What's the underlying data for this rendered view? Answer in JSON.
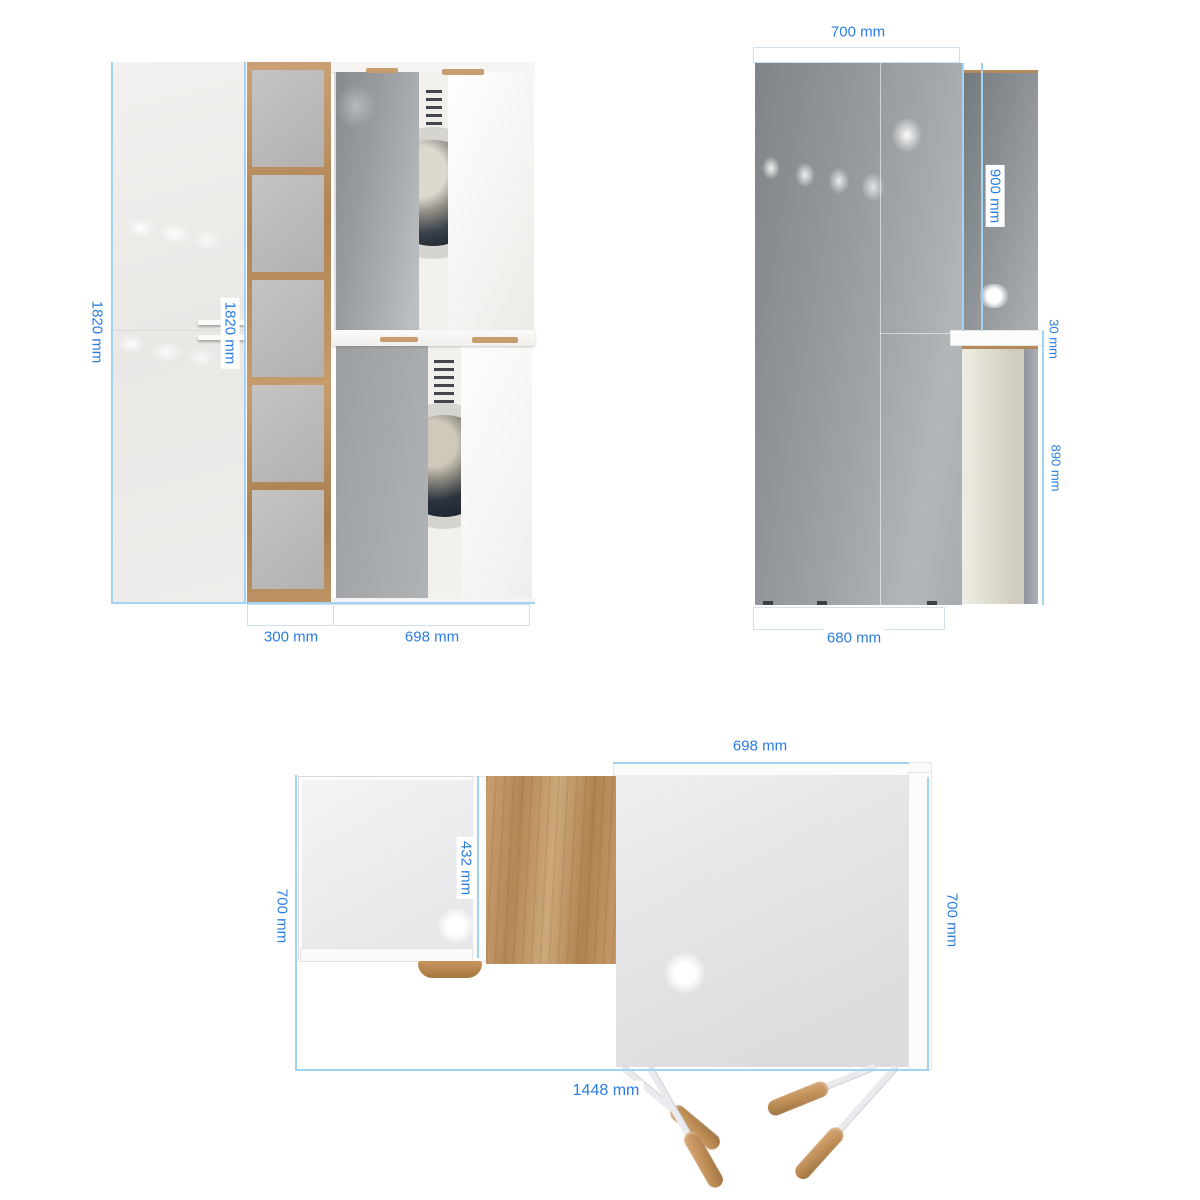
{
  "meta": {
    "units": "mm",
    "colors": {
      "dimension_text": "#2b7ce0",
      "dimension_line": "#a3d3f2",
      "bracket_border": "#cfe0ee",
      "wood_frame": "#c1955f",
      "glossy_gray_panel": "#9aa0a5",
      "white_panel": "#f1efec",
      "beige_panel": "#d6d2c6",
      "leg_wood": "#bc8c55",
      "background": "#ffffff"
    }
  },
  "front_view": {
    "labels": {
      "total_height": "1820 mm",
      "door_height": "1820 mm",
      "shelf_width": "300 mm",
      "cabinet_width": "698 mm"
    }
  },
  "side_view": {
    "labels": {
      "top_depth": "700 mm",
      "upper_panel_height": "900 mm",
      "worktop_thickness": "30 mm",
      "lower_panel_height": "890 mm",
      "bottom_depth": "680 mm"
    }
  },
  "plan_view": {
    "labels": {
      "cabinet_depth": "698 mm",
      "left_depth": "700 mm",
      "inner_depth": "432 mm",
      "right_depth": "700 mm",
      "total_width": "1448 mm"
    }
  }
}
